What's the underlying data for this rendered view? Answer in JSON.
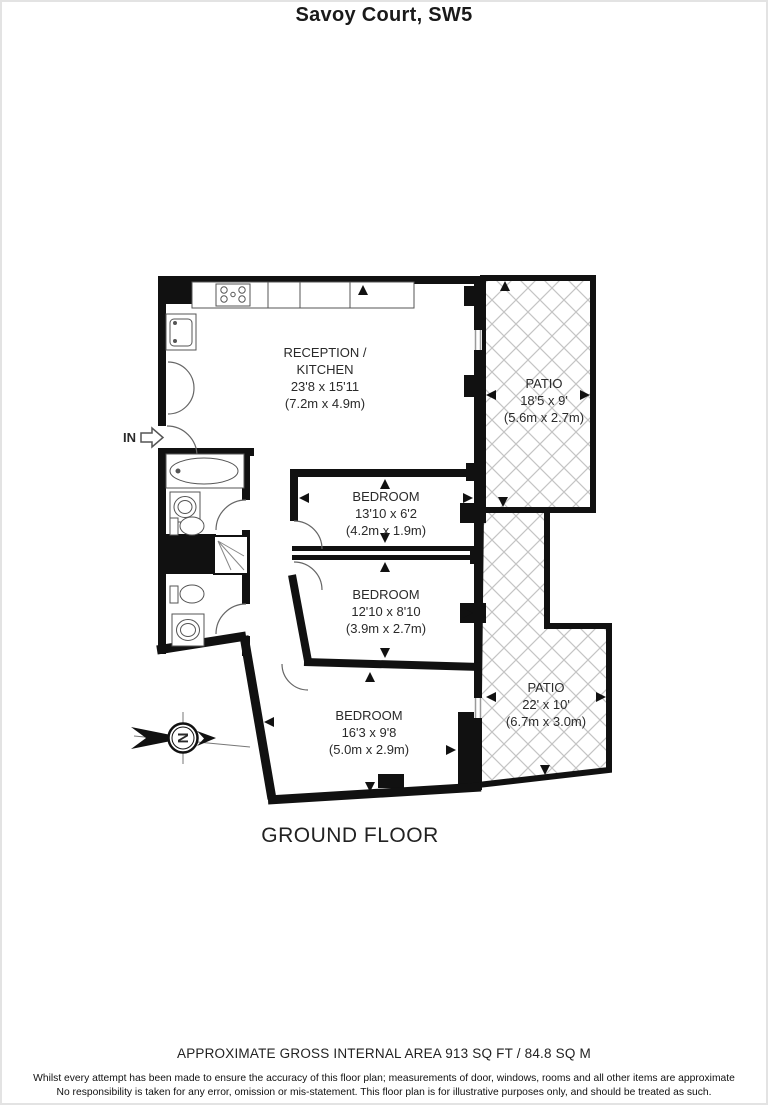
{
  "title": "Savoy Court, SW5",
  "plan": {
    "floor_label": "GROUND FLOOR",
    "entrance_label": "IN",
    "compass_letter": "N",
    "rooms": [
      {
        "id": "reception-kitchen",
        "lines": [
          "RECEPTION /",
          "KITCHEN",
          "23'8 x 15'11",
          "(7.2m x 4.9m)"
        ]
      },
      {
        "id": "patio-top",
        "lines": [
          "PATIO",
          "18'5 x 9'",
          "(5.6m x 2.7m)"
        ]
      },
      {
        "id": "bedroom-1",
        "lines": [
          "BEDROOM",
          "13'10 x 6'2",
          "(4.2m x 1.9m)"
        ]
      },
      {
        "id": "bedroom-2",
        "lines": [
          "BEDROOM",
          "12'10 x 8'10",
          "(3.9m x 2.7m)"
        ]
      },
      {
        "id": "bedroom-3",
        "lines": [
          "BEDROOM",
          "16'3 x 9'8",
          "(5.0m x 2.9m)"
        ]
      },
      {
        "id": "patio-bottom",
        "lines": [
          "PATIO",
          "22' x 10'",
          "(6.7m x 3.0m)"
        ]
      }
    ]
  },
  "footer": {
    "area_note": "APPROXIMATE GROSS INTERNAL AREA 913 SQ FT / 84.8 SQ M",
    "disclaimer": [
      "Whilst every attempt has been made to ensure the accuracy of this floor plan; measurements of door, windows, rooms and all other items are approximate",
      "No responsibility is taken for any error, omission or mis-statement. This floor plan is for illustrative purposes only, and should be treated as such."
    ]
  },
  "colors": {
    "wall": "#111111",
    "hatch": "#c4c4c4",
    "text": "#2a2a2a"
  }
}
